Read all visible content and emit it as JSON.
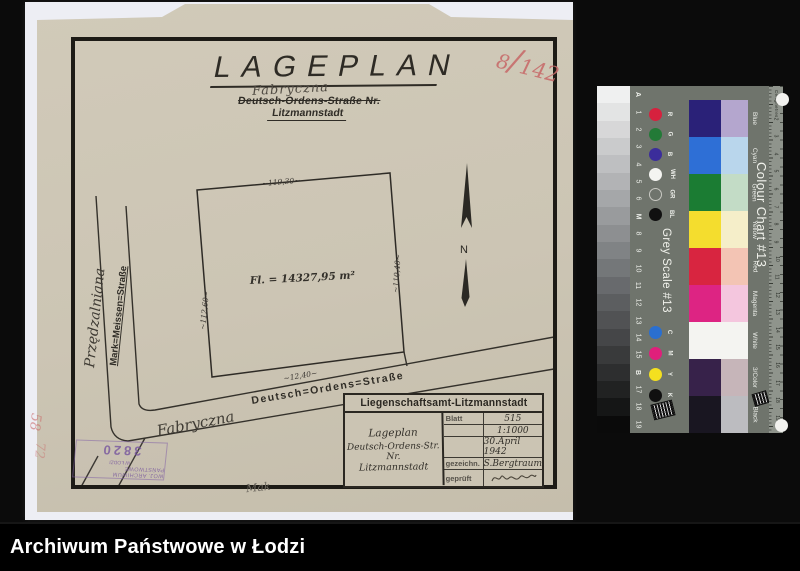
{
  "window": {
    "footer": "Archiwum Państwowe w Łodzi"
  },
  "plan": {
    "title": "LAGEPLAN",
    "crossed_old_name": "Fabryczna",
    "address_line": "Deutsch-Ordens-Straße Nr.",
    "city": "Litzmannstadt",
    "red_number": {
      "numerator": "8",
      "slash": "/",
      "denominator": "142"
    },
    "area_label": "Fl. = 14327,95 m²",
    "dims": {
      "top": "~119,30~",
      "right": "~110,40~",
      "left": "~112,60~",
      "street": "~12,40~"
    },
    "north_label": "N",
    "streets": {
      "handwritten_vertical": "Przędzalniana",
      "printed_vertical": "Mark=Meissen=Straße",
      "printed_diagonal": "Deutsch=Ordens=Straße",
      "handwritten_diagonal": "Fabryczna"
    },
    "archive_stamp": {
      "line1": "WOJ. ARCHIWUM PAŃSTWOWE",
      "line2": "W ŁODZI",
      "number": "3820"
    },
    "margin_marks": {
      "mark1": "58",
      "mark2": "72"
    },
    "pencil_initials": "Mak",
    "title_block": {
      "header": "Liegenschaftsamt-Litzmannstadt",
      "subject": [
        "Lageplan",
        "Deutsch-Ordens-Str.",
        "Nr.",
        "Litzmannstadt"
      ],
      "rows": [
        {
          "label": "Blatt",
          "value": "515"
        },
        {
          "label": "",
          "value": "1:1000"
        },
        {
          "label": "",
          "value": "30.April 1942"
        },
        {
          "label": "gezeichn.",
          "value": "S.Bergtraum"
        },
        {
          "label": "geprüft",
          "value": ""
        }
      ]
    }
  },
  "color_chart": {
    "title": "Colour Chart #13",
    "grey_scale_title": "Grey Scale #13",
    "ruler_label": "Centimetres",
    "grey_steps": [
      "A",
      "1",
      "2",
      "3",
      "4",
      "5",
      "6",
      "M",
      "8",
      "9",
      "10",
      "11",
      "12",
      "13",
      "14",
      "15",
      "B",
      "17",
      "18",
      "19"
    ],
    "ruler_numbers": [
      "1",
      "2",
      "3",
      "4",
      "5",
      "6",
      "7",
      "8",
      "9",
      "10",
      "11",
      "12",
      "13",
      "14",
      "15",
      "16",
      "17",
      "18",
      "19"
    ],
    "primary_dots": [
      {
        "label": "R",
        "color": "#d6213e"
      },
      {
        "label": "G",
        "color": "#237a37"
      },
      {
        "label": "B",
        "color": "#3b2d9b"
      },
      {
        "label": "WH",
        "color": "#f4f4f1"
      },
      {
        "label": "GR",
        "color": "ring"
      },
      {
        "label": "BL",
        "color": "#101010"
      }
    ],
    "cmyk_dots": [
      {
        "label": "C",
        "color": "#2a6fd0"
      },
      {
        "label": "M",
        "color": "#e01f7b"
      },
      {
        "label": "Y",
        "color": "#f4e01f"
      },
      {
        "label": "K",
        "color": "#101010"
      }
    ],
    "patches": [
      {
        "name": "Blue",
        "strong": "#2a2178",
        "pale": "#b4a6ce"
      },
      {
        "name": "Cyan",
        "strong": "#2e6fd6",
        "pale": "#b9d6ec"
      },
      {
        "name": "Green",
        "strong": "#1b7c33",
        "pale": "#c3dcc6"
      },
      {
        "name": "Yellow",
        "strong": "#f4dd2e",
        "pale": "#f5eec9"
      },
      {
        "name": "Red",
        "strong": "#d82540",
        "pale": "#f3c4b4"
      },
      {
        "name": "Magenta",
        "strong": "#dd2483",
        "pale": "#f4c6de"
      },
      {
        "name": "White",
        "strong": "#f4f4f1",
        "pale": "#f4f4f1"
      },
      {
        "name": "3/Color",
        "strong": "#37224a",
        "pale": "#c6b5b9"
      },
      {
        "name": "Black",
        "strong": "#191621",
        "pale": "#bcbcc0"
      }
    ]
  }
}
